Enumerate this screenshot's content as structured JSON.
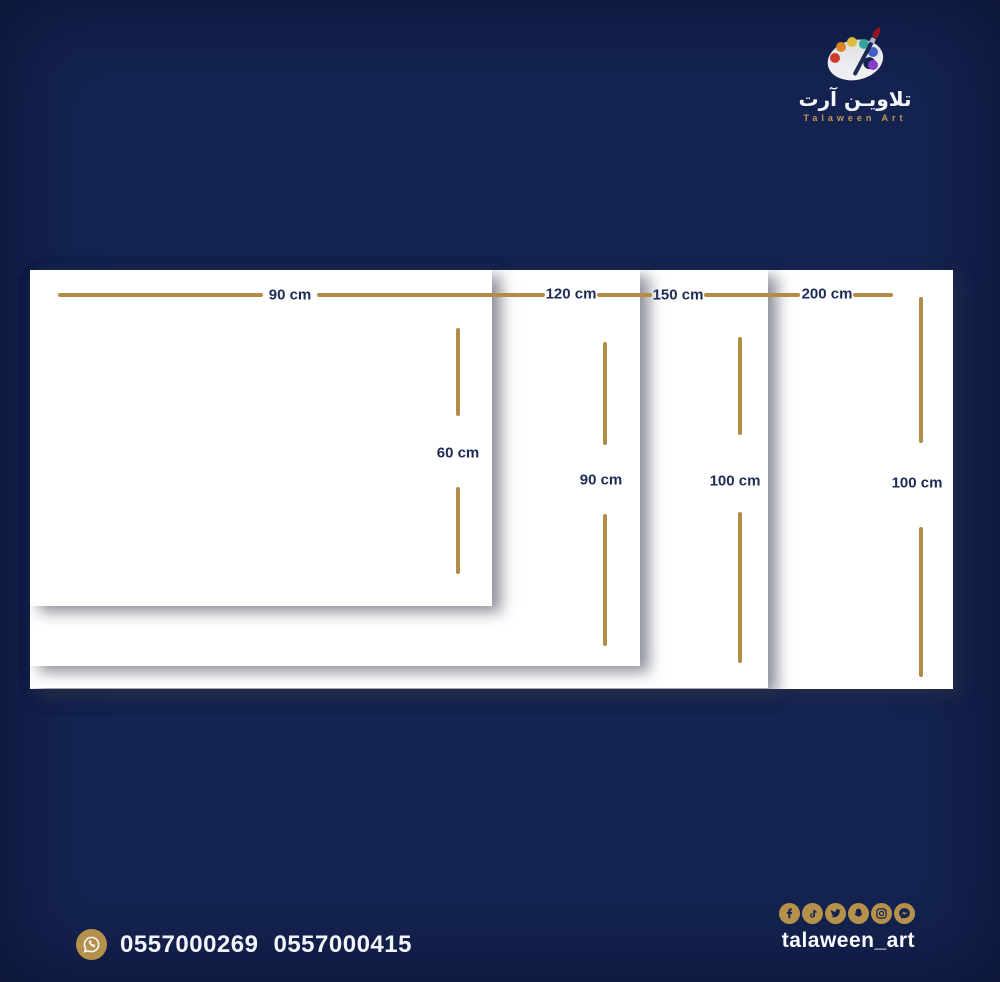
{
  "logo": {
    "arabic_name": "تلاويـن آرت",
    "english_name": "Talaween Art"
  },
  "sizes": [
    {
      "width_label": "90 cm",
      "height_label": "60 cm"
    },
    {
      "width_label": "120 cm",
      "height_label": "90 cm"
    },
    {
      "width_label": "150 cm",
      "height_label": "100 cm"
    },
    {
      "width_label": "200 cm",
      "height_label": "100 cm"
    }
  ],
  "contact": {
    "phone_1": "0557000269",
    "phone_2": "0557000415"
  },
  "social": {
    "handle": "talaween_art",
    "icons": [
      "facebook",
      "tiktok",
      "twitter",
      "snapchat",
      "instagram",
      "messenger"
    ]
  },
  "colors": {
    "background": "#142350",
    "gold": "#b28b47",
    "label": "#1e2c55",
    "panel": "#ffffff"
  }
}
